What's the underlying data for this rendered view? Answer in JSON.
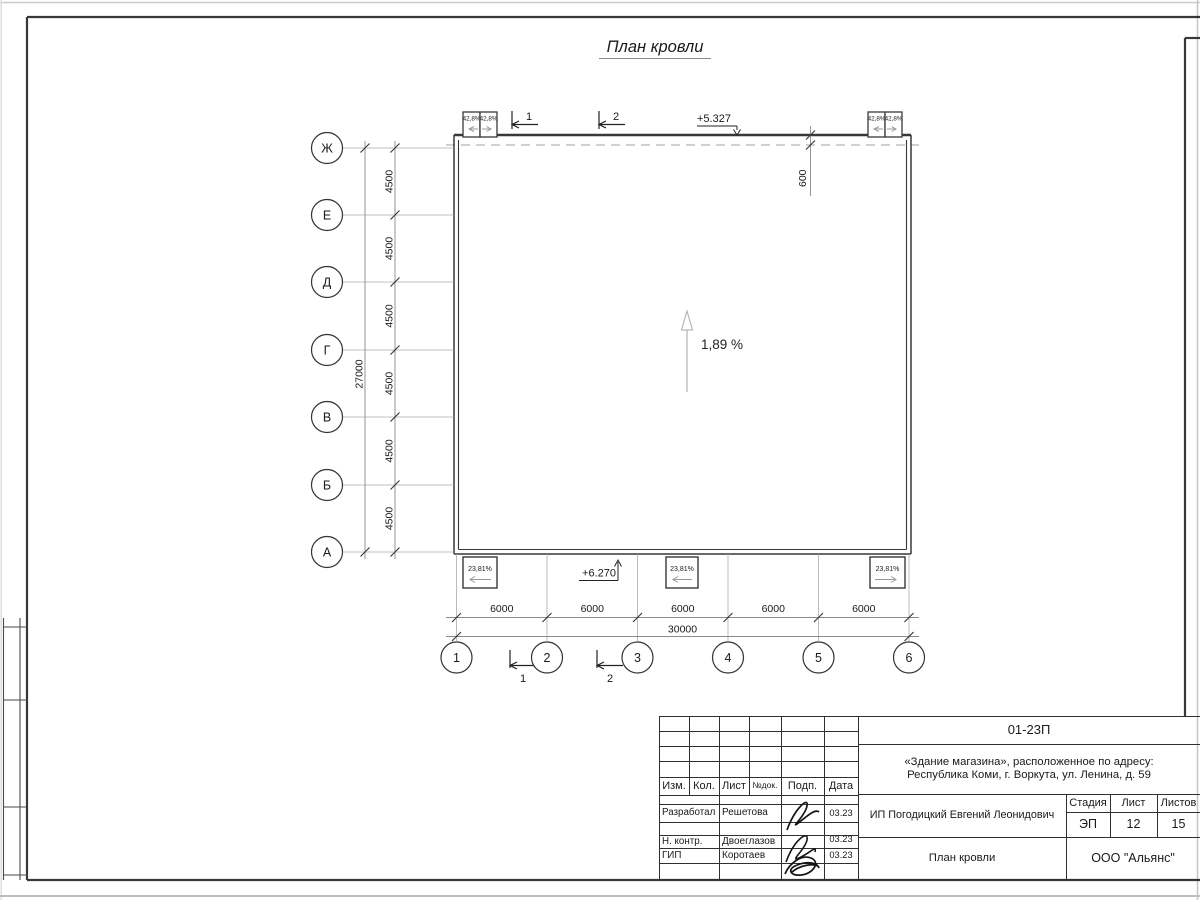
{
  "page": {
    "title": "План кровли"
  },
  "axes": {
    "rows": [
      "Ж",
      "Е",
      "Д",
      "Г",
      "В",
      "Б",
      "А"
    ],
    "cols": [
      "1",
      "2",
      "3",
      "4",
      "5",
      "6"
    ]
  },
  "dims": {
    "row_spacing": [
      "4500",
      "4500",
      "4500",
      "4500",
      "4500",
      "4500"
    ],
    "row_total": "27000",
    "col_spacing": [
      "6000",
      "6000",
      "6000",
      "6000",
      "6000"
    ],
    "col_total": "30000",
    "overhang": "600"
  },
  "elevations": {
    "top": "+5.327",
    "bottom": "+6.270"
  },
  "slopes": {
    "main": "1,89 %",
    "top": [
      "42,8%",
      "42,8%",
      "42,8%",
      "42,8%"
    ],
    "bottom": [
      "23,81%",
      "23,81%",
      "23,81%"
    ]
  },
  "sections": {
    "s1": "1",
    "s2": "2"
  },
  "titleblock": {
    "code": "01-23П",
    "project_line1": "«Здание магазина», расположенное по адресу:",
    "project_line2": "Республика Коми, г. Воркута, ул. Ленина, д. 59",
    "client": "ИП Погодицкий Евгений Леонидович",
    "header": {
      "izm": "Изм.",
      "kol": "Кол.",
      "list": "Лист",
      "ndok": "№док.",
      "podp": "Подп.",
      "data": "Дата"
    },
    "stage_label": "Стадия",
    "sheet_label": "Лист",
    "sheets_label": "Листов",
    "stage": "ЭП",
    "sheet": "12",
    "sheets": "15",
    "drawing_name": "План кровли",
    "company": "ООО \"Альянс\"",
    "roles": [
      {
        "role": "Разработал",
        "name": "Решетова",
        "date": "03.23"
      },
      {
        "role": "Н. контр.",
        "name": "Двоеглазов",
        "date": "03.23"
      },
      {
        "role": "ГИП",
        "name": "Коротаев",
        "date": "03.23"
      }
    ]
  }
}
